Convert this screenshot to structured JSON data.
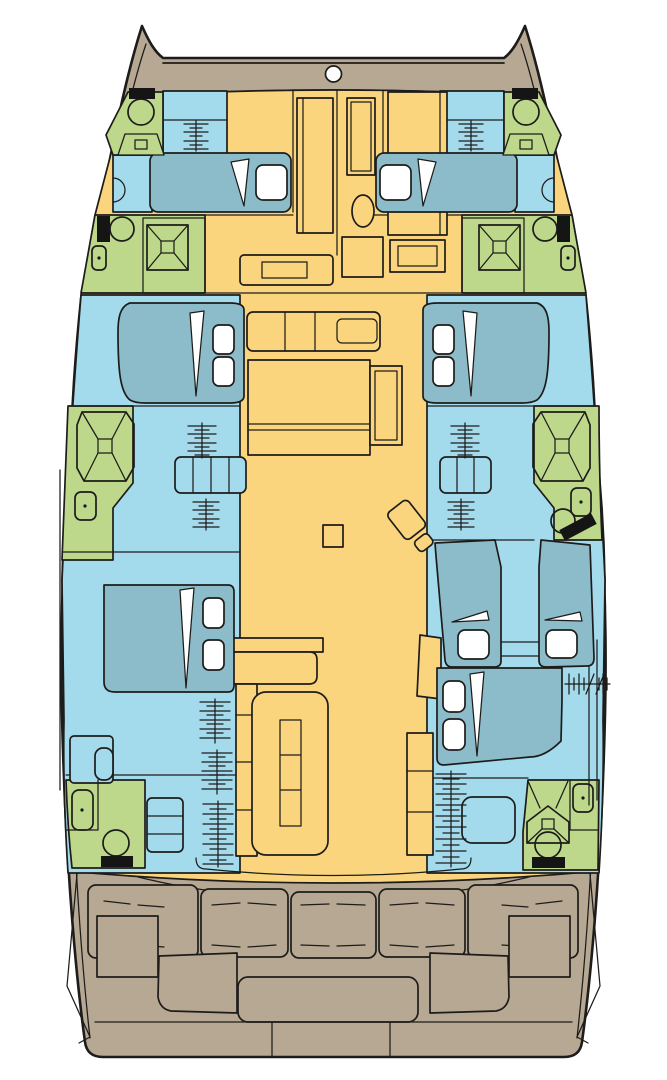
{
  "canvas": {
    "width": 667,
    "height": 1080
  },
  "colors": {
    "background": "#ffffff",
    "outline": "#1d1c1a",
    "hull_deck": "#b6a893",
    "saloon_floor": "#fad57e",
    "cabin_floor": "#a3daec",
    "bed": "#8cbcca",
    "bathroom": "#bdd88b",
    "fixture_black": "#151515",
    "linen_white": "#ffffff"
  },
  "legend": {
    "hull_deck": "exterior deck / cockpit",
    "saloon_floor": "saloon, galley and corridors",
    "cabin_floor": "hull cabins",
    "bed": "berths / mattresses",
    "bathroom": "heads and showers"
  },
  "rooms": {
    "port_hull": [
      "forepeak-head",
      "forward-cabin",
      "forward-head",
      "mid-cabin",
      "mid-head",
      "aft-cabin",
      "aft-head"
    ],
    "starboard_hull": [
      "forepeak-head",
      "forward-cabin",
      "forward-head",
      "mid-cabin",
      "mid-head",
      "bunk-cabin",
      "aft-cabin",
      "aft-head"
    ],
    "bridgedeck": [
      "foredeck-corridor",
      "galley",
      "saloon-dining",
      "aft-cockpit"
    ]
  },
  "berths": {
    "double_beds": 4,
    "single_beds": 4,
    "pillows": 12
  },
  "fixtures": {
    "toilets": 7,
    "sinks": 6,
    "showers": 5,
    "step_ladder_runs": 11,
    "bow_hatches": 2,
    "forestay_ring": 1
  },
  "cockpit": {
    "bench_cushions": 5,
    "tables": 1,
    "side_seats": 2,
    "access_wedges": 2,
    "transom_sections": 3
  }
}
